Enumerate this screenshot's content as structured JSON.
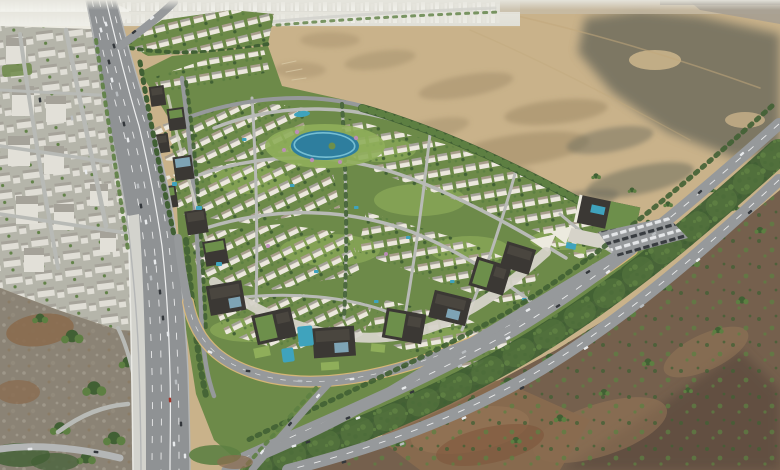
{
  "scene": {
    "type": "aerial-architectural-render",
    "description": "Aerial rendering of a master-planned desert villa community: curving rows of white villas around a central lagoon, a dark commercial office row along an arcing ring road, an elevated multi-lane highway and existing white apartment city on the left, hazy skyline on the horizon, open sand plain to the north-east and brown scrubland with shrubs along a landscaped boulevard to the south-east.",
    "landmarks": {
      "existing_city": "Existing apartment city district",
      "skyline": "Distant hazy city skyline",
      "highway": "Multi-lane highway with elevated viaduct",
      "villa_community": "Master-planned villa community",
      "north_villa_row": "Detached villa rows at the northern edge",
      "lagoon": "Central landscaped lagoon with island",
      "office_row": "Dark low-rise office and retail buildings",
      "clubhouse": "Clubhouse with green roof, pools and parking",
      "boulevard": "Tree-lined arterial boulevard",
      "ring_road": "Inner ring road with lit curb",
      "desert": "Open sand plain",
      "scrubland": "Brown desert scrub with shrubs",
      "rocky_park": "Rocky landscaped slope beside highway"
    },
    "palette": {
      "sand": "#c9b28a",
      "sand_shadow": "#9c8764",
      "sand_track": "#c1a87c",
      "desert_olive": "#6f6d5d",
      "scrub_brown": "#75604d",
      "scrub_dark": "#5f4e41",
      "scrub_rust": "#7c5238",
      "dirt": "#8a6b4f",
      "dirt_light": "#967757",
      "green_base": "#6d8a49",
      "lawn": "#8fae5a",
      "tree_dark": "#416034",
      "tree_mid": "#5d7f42",
      "villa_wall": "#ece8dd",
      "villa_roof": "#a89d8c",
      "city_ground": "#b5b5aa",
      "city_block": "#e2e0d8",
      "city_roof": "#a5a299",
      "rock": "#8b8375",
      "rock_stone": "#a39c8e",
      "haze": "#dfded6",
      "haze_warm": "#c7bca6",
      "haze_grey": "#a49e92",
      "skyline": "#f2f2ec",
      "asphalt": "#96999b",
      "road_minor": "#b8bab6",
      "highway": "#8f9294",
      "shoulder": "#b4b6b6",
      "concrete": "#d3d3cd",
      "plaza": "#d6d3c9",
      "ring_curb": "#e0ba7c",
      "lane_line": "#ffffff",
      "water_deep": "#2e7e9e",
      "water_light": "#7ec6d8",
      "pool": "#3fa3bd",
      "building_dark": "#3b3834",
      "building_face": "#4a463f",
      "roof_green": "#6d8f4b",
      "glass": "#7ea4b5",
      "canopy": "#eceade",
      "pink_tree": "#c08bbf",
      "car_white": "#e8eaec",
      "car_grey": "#b9bdc0",
      "car_dark": "#33373b",
      "car_red": "#a33327"
    }
  }
}
